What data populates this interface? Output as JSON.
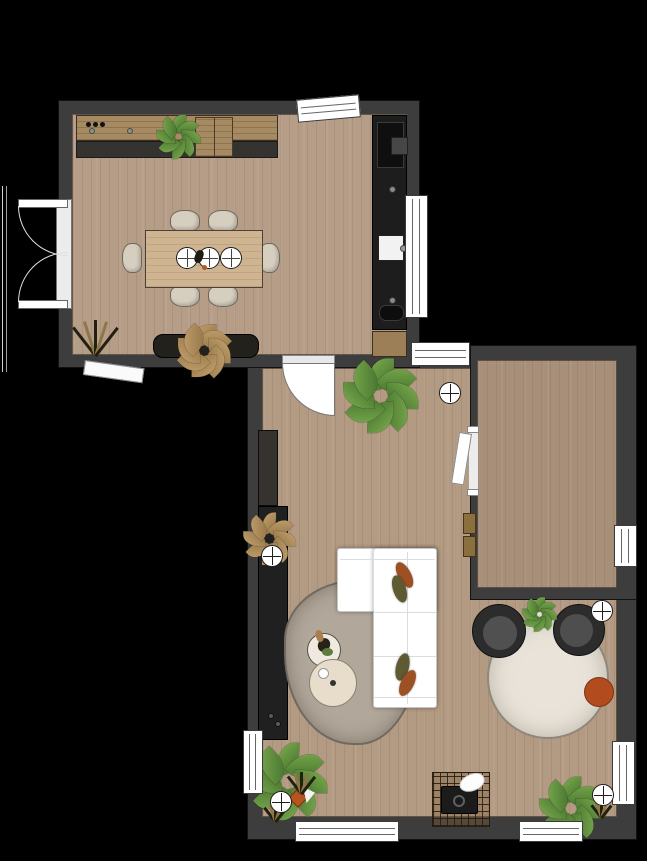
{
  "meta": {
    "type": "floor-plan",
    "view": "top-down rendered plan",
    "text_labels": []
  },
  "palette": {
    "background": "#000000",
    "wall": "#3d3d3d",
    "kitchen_floor": "#b59d88",
    "living_floor": "#b39a83",
    "side_room_floor": "#a78f7a",
    "counter_wood": "#a68a62",
    "cabinet_dark": "#1d1d1d",
    "credenza_dark": "#23211c",
    "table_wood": "#cfb492",
    "chair_cream": "#d6cfc0",
    "sofa_white": "#ffffff",
    "rug_blob": "#b1a79a",
    "rug_round": "#e9e3d9",
    "armchair_dark": "#2c2c2c",
    "armchair_seat": "#505050",
    "ottoman_rust": "#b24b1d",
    "pillow_rust": "#9c5024",
    "pillow_olive": "#5e5a32",
    "leaf_green": "#3f6b2a",
    "leaf_light": "#7fb051",
    "dried_tan": "#c7a571",
    "radiator_brass": "#8a6f3f",
    "window_white": "#ffffff"
  },
  "rooms": [
    {
      "name": "kitchen-dining",
      "contents": [
        "wall counter with cooktop knobs",
        "counter cabinet",
        "counter plant",
        "tall appliance column with oven and sink",
        "base cabinet",
        "dining table",
        "3 place settings",
        "6 chairs",
        "dark credenza with dried plant",
        "grass plant",
        "double exterior doors",
        "tilted top window",
        "side window",
        "awning below wall"
      ]
    },
    {
      "name": "living-room",
      "contents": [
        "door from kitchen with swing arc",
        "large potted plant",
        "tall cabinet",
        "media console with knobs and dried plant",
        "L-shaped white sofa",
        "4 throw pillows",
        "organic blob rug",
        "round side table with decor",
        "round coffee table",
        "2 dark armchairs",
        "plant stand table",
        "large round rug",
        "rust pouf",
        "grid pet mat with pet bed and white cat",
        "floor plants",
        "orange potted plant",
        "spiky grasses",
        "wall radiator"
      ]
    },
    {
      "name": "side-room",
      "contents": [
        "empty wood floor",
        "door to living room"
      ]
    }
  ],
  "fixtures": {
    "ceiling_lights": 5,
    "windows": 8,
    "door_sets": [
      "double-exterior-door",
      "kitchen-living-door",
      "side-room-door"
    ],
    "counts": {
      "dining_chairs": 6,
      "plates": 3,
      "sofa_pillows": 4,
      "armchairs": 2
    }
  }
}
